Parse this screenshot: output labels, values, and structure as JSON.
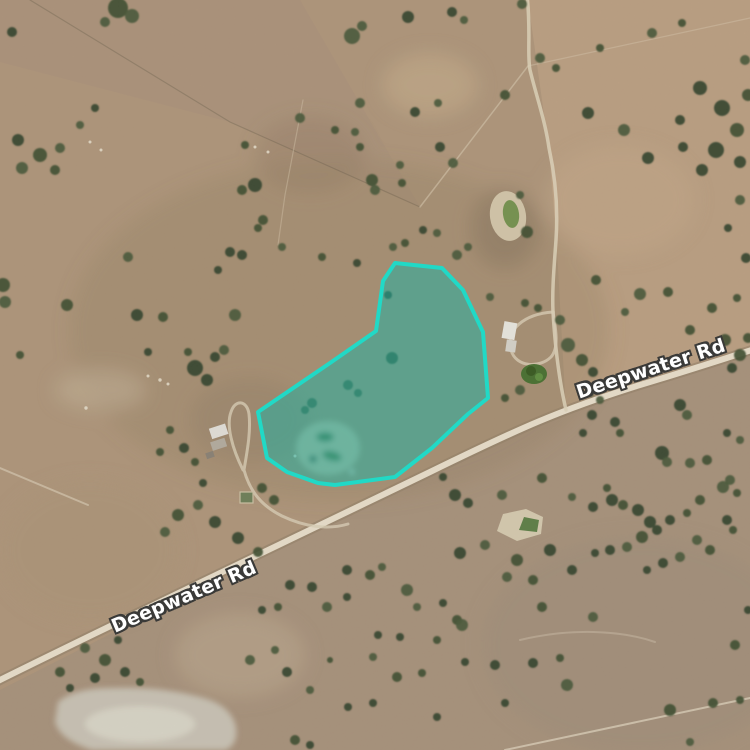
{
  "map": {
    "type": "satellite-aerial-view",
    "road_labels": [
      {
        "text": "Deepwater Rd",
        "x": 184,
        "y": 597,
        "rotation": -23
      },
      {
        "text": "Deepwater Rd",
        "x": 651,
        "y": 369,
        "rotation": -18
      }
    ],
    "highlight": {
      "name": "selected-property-boundary",
      "points": "395,263 442,268 463,290 483,332 488,398 468,414 432,448 395,477 335,485 318,483 287,472 267,458 258,412 330,363 376,331 383,281",
      "stroke": "#21d9c6",
      "fill": "rgba(25,180,165,0.5)",
      "stroke_width": 4
    },
    "roads": {
      "main_road": "M -8,684 C 100,630 300,535 430,472 C 520,428 560,410 640,385 C 690,370 720,360 758,348",
      "track_north": "M 527,-5 C 531,30 527,55 530,70 C 536,95 545,120 549,148 C 556,180 558,210 556,240 C 554,268 552,290 553,312",
      "track_to_road": "M 553,312 C 555,345 559,380 566,410",
      "driveway_loop": "M 553,312 C 524,314 505,330 511,350 C 516,368 540,368 551,357 C 559,348 556,330 553,312",
      "left_homestead_track": "M 243,470 C 232,448 226,425 231,412 C 235,399 247,400 249,414 C 251,432 247,452 244,470 C 250,492 262,506 282,516 C 305,527 328,530 348,524",
      "faint_track_southeast": "M 520,640 C 570,628 620,630 655,642"
    }
  },
  "terrain": {
    "palette": {
      "base": "#b0977c",
      "paddock_light": "#c6a98b",
      "paddock_gray": "#a18f7e",
      "road_surface": "#ece3d0",
      "tree_dark": "#3c4e32",
      "pond_water": "#74934f",
      "dam_water": "#5c7f46",
      "salt_pan": "#dedace"
    },
    "trees": [
      [
        118,
        8,
        10
      ],
      [
        132,
        16,
        7
      ],
      [
        105,
        22,
        5
      ],
      [
        352,
        36,
        8
      ],
      [
        362,
        26,
        5
      ],
      [
        408,
        17,
        6
      ],
      [
        452,
        12,
        5
      ],
      [
        464,
        20,
        4
      ],
      [
        522,
        4,
        5
      ],
      [
        540,
        58,
        5
      ],
      [
        556,
        68,
        4
      ],
      [
        600,
        48,
        4
      ],
      [
        652,
        33,
        5
      ],
      [
        682,
        23,
        4
      ],
      [
        505,
        95,
        5
      ],
      [
        588,
        113,
        6
      ],
      [
        624,
        130,
        6
      ],
      [
        648,
        158,
        6
      ],
      [
        700,
        88,
        7
      ],
      [
        722,
        108,
        8
      ],
      [
        737,
        130,
        7
      ],
      [
        716,
        150,
        8
      ],
      [
        740,
        162,
        6
      ],
      [
        702,
        170,
        6
      ],
      [
        683,
        147,
        5
      ],
      [
        748,
        95,
        6
      ],
      [
        745,
        60,
        5
      ],
      [
        680,
        120,
        5
      ],
      [
        740,
        200,
        5
      ],
      [
        728,
        228,
        4
      ],
      [
        746,
        258,
        5
      ],
      [
        737,
        298,
        4
      ],
      [
        596,
        280,
        5
      ],
      [
        640,
        294,
        6
      ],
      [
        668,
        292,
        5
      ],
      [
        690,
        330,
        5
      ],
      [
        625,
        312,
        4
      ],
      [
        712,
        308,
        5
      ],
      [
        725,
        340,
        6
      ],
      [
        740,
        355,
        6
      ],
      [
        732,
        368,
        5
      ],
      [
        748,
        338,
        5
      ],
      [
        360,
        103,
        5
      ],
      [
        415,
        112,
        5
      ],
      [
        438,
        103,
        4
      ],
      [
        355,
        132,
        4
      ],
      [
        360,
        147,
        4
      ],
      [
        400,
        165,
        4
      ],
      [
        440,
        147,
        5
      ],
      [
        453,
        163,
        5
      ],
      [
        372,
        180,
        6
      ],
      [
        375,
        190,
        5
      ],
      [
        402,
        183,
        4
      ],
      [
        255,
        185,
        7
      ],
      [
        242,
        190,
        5
      ],
      [
        263,
        220,
        5
      ],
      [
        258,
        228,
        4
      ],
      [
        282,
        247,
        4
      ],
      [
        242,
        255,
        5
      ],
      [
        322,
        257,
        4
      ],
      [
        357,
        263,
        4
      ],
      [
        393,
        247,
        4
      ],
      [
        405,
        243,
        4
      ],
      [
        423,
        230,
        4
      ],
      [
        437,
        233,
        4
      ],
      [
        457,
        255,
        5
      ],
      [
        468,
        247,
        4
      ],
      [
        300,
        118,
        5
      ],
      [
        335,
        130,
        4
      ],
      [
        245,
        145,
        4
      ],
      [
        12,
        32,
        5
      ],
      [
        18,
        140,
        6
      ],
      [
        40,
        155,
        7
      ],
      [
        22,
        168,
        6
      ],
      [
        55,
        170,
        5
      ],
      [
        95,
        108,
        4
      ],
      [
        80,
        125,
        4
      ],
      [
        60,
        148,
        5
      ],
      [
        3,
        285,
        7
      ],
      [
        5,
        302,
        6
      ],
      [
        128,
        257,
        5
      ],
      [
        67,
        305,
        6
      ],
      [
        137,
        315,
        6
      ],
      [
        163,
        317,
        5
      ],
      [
        230,
        252,
        5
      ],
      [
        218,
        270,
        4
      ],
      [
        235,
        315,
        6
      ],
      [
        20,
        355,
        4
      ],
      [
        148,
        352,
        4
      ],
      [
        195,
        368,
        8
      ],
      [
        207,
        380,
        6
      ],
      [
        215,
        357,
        5
      ],
      [
        224,
        350,
        5
      ],
      [
        188,
        352,
        4
      ],
      [
        184,
        448,
        5
      ],
      [
        195,
        462,
        4
      ],
      [
        170,
        430,
        4
      ],
      [
        160,
        452,
        4
      ],
      [
        203,
        483,
        4
      ],
      [
        262,
        488,
        5
      ],
      [
        274,
        500,
        5
      ],
      [
        392,
        358,
        6
      ],
      [
        348,
        385,
        5
      ],
      [
        358,
        393,
        4
      ],
      [
        312,
        403,
        5
      ],
      [
        305,
        410,
        4
      ],
      [
        388,
        295,
        4
      ],
      [
        568,
        345,
        7
      ],
      [
        582,
        360,
        6
      ],
      [
        593,
        372,
        5
      ],
      [
        560,
        320,
        5
      ],
      [
        520,
        390,
        5
      ],
      [
        505,
        398,
        4
      ],
      [
        525,
        303,
        4
      ],
      [
        538,
        308,
        4
      ],
      [
        490,
        297,
        4
      ],
      [
        527,
        232,
        6
      ],
      [
        520,
        195,
        4
      ],
      [
        455,
        495,
        6
      ],
      [
        468,
        503,
        5
      ],
      [
        460,
        553,
        6
      ],
      [
        485,
        545,
        5
      ],
      [
        517,
        560,
        6
      ],
      [
        550,
        550,
        6
      ],
      [
        572,
        570,
        5
      ],
      [
        502,
        495,
        5
      ],
      [
        542,
        478,
        5
      ],
      [
        572,
        497,
        4
      ],
      [
        593,
        507,
        5
      ],
      [
        607,
        488,
        4
      ],
      [
        443,
        477,
        4
      ],
      [
        507,
        577,
        5
      ],
      [
        533,
        580,
        5
      ],
      [
        290,
        585,
        5
      ],
      [
        312,
        587,
        5
      ],
      [
        347,
        570,
        5
      ],
      [
        370,
        575,
        5
      ],
      [
        382,
        567,
        4
      ],
      [
        407,
        590,
        6
      ],
      [
        347,
        597,
        4
      ],
      [
        327,
        607,
        5
      ],
      [
        278,
        607,
        4
      ],
      [
        262,
        610,
        4
      ],
      [
        250,
        660,
        5
      ],
      [
        275,
        650,
        4
      ],
      [
        287,
        672,
        5
      ],
      [
        310,
        690,
        4
      ],
      [
        348,
        707,
        4
      ],
      [
        373,
        703,
        4
      ],
      [
        330,
        660,
        3
      ],
      [
        373,
        657,
        4
      ],
      [
        397,
        677,
        5
      ],
      [
        422,
        673,
        4
      ],
      [
        437,
        717,
        4
      ],
      [
        378,
        635,
        4
      ],
      [
        400,
        637,
        4
      ],
      [
        437,
        640,
        4
      ],
      [
        457,
        620,
        5
      ],
      [
        443,
        603,
        4
      ],
      [
        417,
        607,
        4
      ],
      [
        295,
        740,
        5
      ],
      [
        310,
        745,
        4
      ],
      [
        178,
        515,
        6
      ],
      [
        198,
        505,
        5
      ],
      [
        215,
        522,
        6
      ],
      [
        238,
        538,
        6
      ],
      [
        258,
        552,
        5
      ],
      [
        165,
        532,
        5
      ],
      [
        85,
        648,
        5
      ],
      [
        105,
        660,
        6
      ],
      [
        125,
        672,
        5
      ],
      [
        118,
        640,
        4
      ],
      [
        70,
        688,
        4
      ],
      [
        95,
        678,
        5
      ],
      [
        60,
        672,
        5
      ],
      [
        140,
        682,
        4
      ],
      [
        680,
        405,
        6
      ],
      [
        687,
        415,
        5
      ],
      [
        662,
        453,
        7
      ],
      [
        667,
        462,
        5
      ],
      [
        690,
        463,
        5
      ],
      [
        707,
        460,
        5
      ],
      [
        615,
        422,
        5
      ],
      [
        620,
        433,
        4
      ],
      [
        592,
        415,
        5
      ],
      [
        583,
        433,
        4
      ],
      [
        612,
        500,
        6
      ],
      [
        623,
        505,
        5
      ],
      [
        638,
        510,
        6
      ],
      [
        650,
        522,
        6
      ],
      [
        657,
        530,
        5
      ],
      [
        642,
        537,
        6
      ],
      [
        627,
        547,
        5
      ],
      [
        610,
        550,
        5
      ],
      [
        595,
        553,
        4
      ],
      [
        670,
        520,
        5
      ],
      [
        687,
        513,
        4
      ],
      [
        700,
        500,
        5
      ],
      [
        723,
        487,
        6
      ],
      [
        730,
        480,
        5
      ],
      [
        737,
        493,
        4
      ],
      [
        697,
        540,
        5
      ],
      [
        710,
        550,
        5
      ],
      [
        680,
        557,
        5
      ],
      [
        663,
        563,
        5
      ],
      [
        647,
        570,
        4
      ],
      [
        727,
        520,
        5
      ],
      [
        733,
        530,
        4
      ],
      [
        600,
        400,
        4
      ],
      [
        590,
        393,
        4
      ],
      [
        727,
        433,
        4
      ],
      [
        740,
        440,
        4
      ],
      [
        462,
        625,
        6
      ],
      [
        495,
        665,
        5
      ],
      [
        465,
        662,
        4
      ],
      [
        533,
        663,
        5
      ],
      [
        560,
        658,
        4
      ],
      [
        593,
        617,
        5
      ],
      [
        542,
        607,
        5
      ],
      [
        567,
        685,
        6
      ],
      [
        505,
        703,
        4
      ],
      [
        670,
        710,
        6
      ],
      [
        713,
        703,
        5
      ],
      [
        735,
        645,
        5
      ],
      [
        740,
        700,
        4
      ],
      [
        690,
        742,
        4
      ],
      [
        748,
        610,
        4
      ]
    ]
  }
}
